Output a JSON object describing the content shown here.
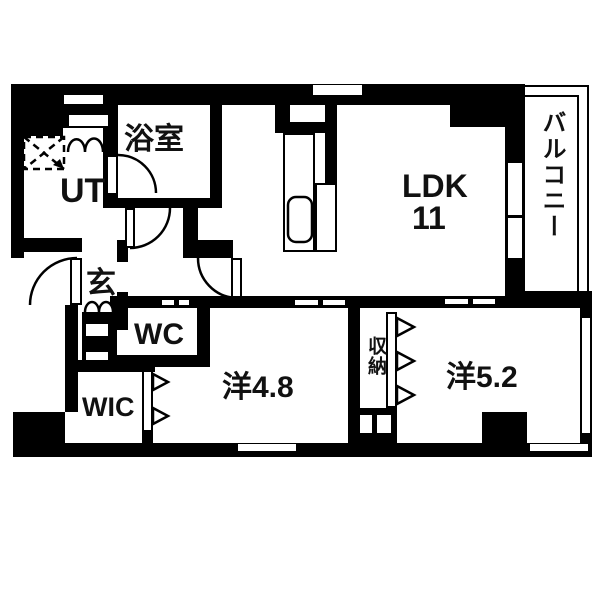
{
  "plan": {
    "title": "apartment-floor-plan",
    "colors": {
      "wall": "#000000",
      "floor": "#ffffff",
      "text": "#111111"
    },
    "rooms": {
      "bath": "浴室",
      "utility": "UT",
      "entrance": "玄",
      "toilet": "WC",
      "walk_in_closet": "WIC",
      "western_room_a": "洋4.8",
      "storage": "収納",
      "western_room_b": "洋5.2",
      "ldk": "LDK",
      "ldk_size": "11",
      "balcony": "バルコニー"
    }
  }
}
